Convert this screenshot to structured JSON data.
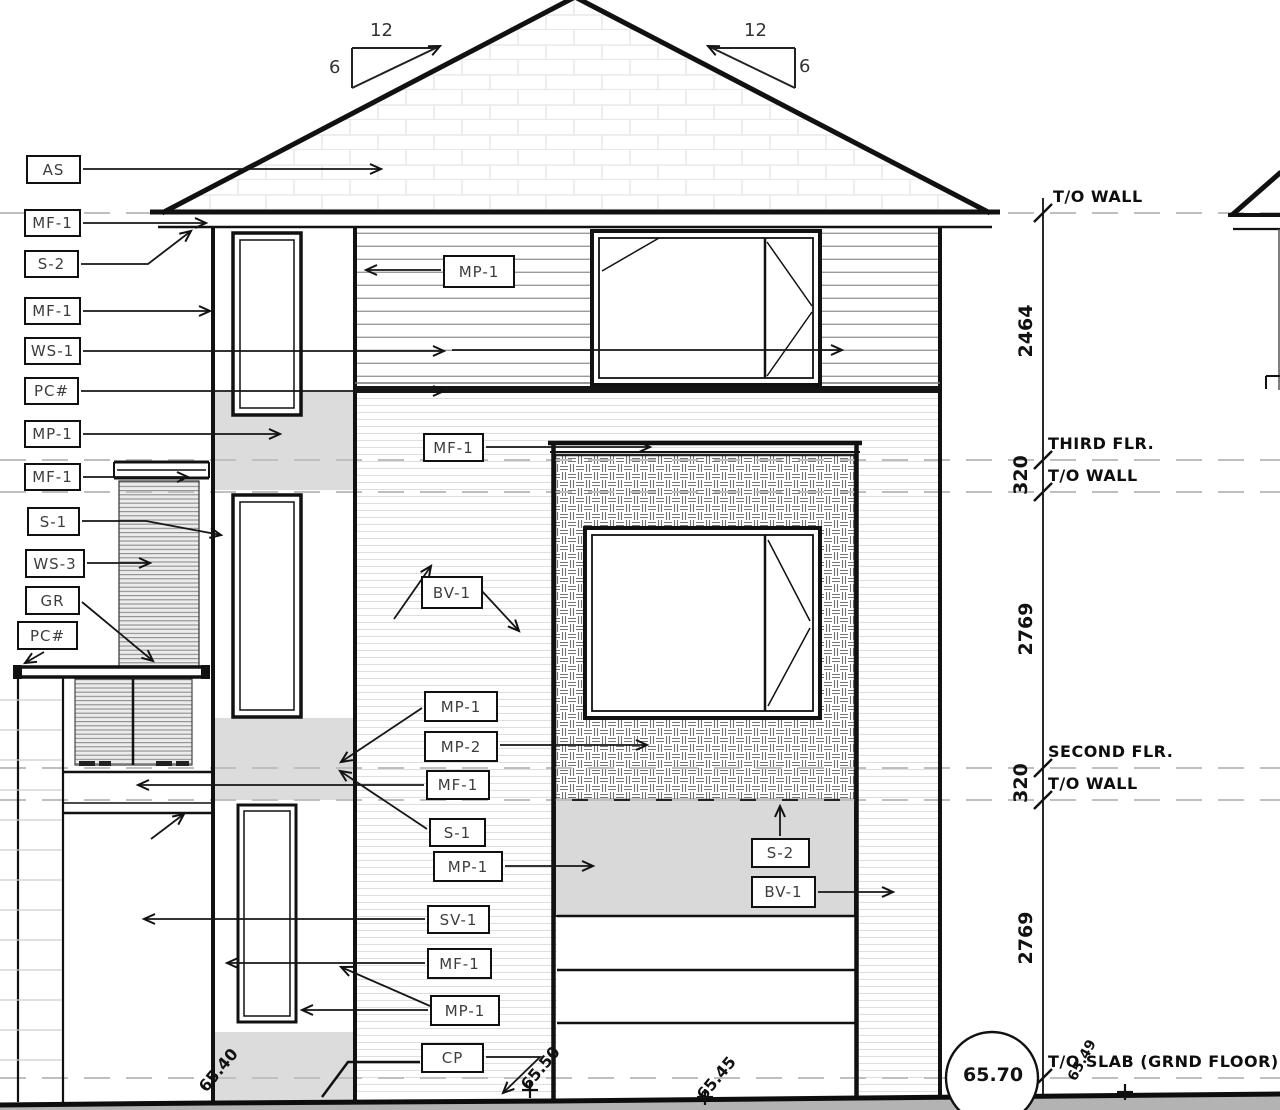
{
  "slope_indicators": {
    "left_run": "12",
    "left_rise": "6",
    "right_run": "12",
    "right_rise": "6"
  },
  "left_labels": [
    "AS",
    "MF-1",
    "S-2",
    "MF-1",
    "WS-1",
    "PC#",
    "MP-1",
    "MF-1",
    "S-1",
    "WS-3",
    "GR",
    "PC#"
  ],
  "callouts": [
    "MP-1",
    "MF-1",
    "BV-1",
    "MP-1",
    "MP-2",
    "MF-1",
    "S-1",
    "MP-1",
    "SV-1",
    "MF-1",
    "MP-1",
    "CP",
    "S-2",
    "BV-1"
  ],
  "levels": [
    "T/O WALL",
    "THIRD FLR.",
    "T/O WALL",
    "SECOND FLR.",
    "T/O WALL",
    "T/O SLAB (GRND FLOOR)"
  ],
  "dimensions": [
    "2464",
    "320",
    "2769",
    "320",
    "2769"
  ],
  "spot_elevations": [
    "65.40",
    "65.50",
    "65.45",
    "65.70",
    "65.49"
  ]
}
